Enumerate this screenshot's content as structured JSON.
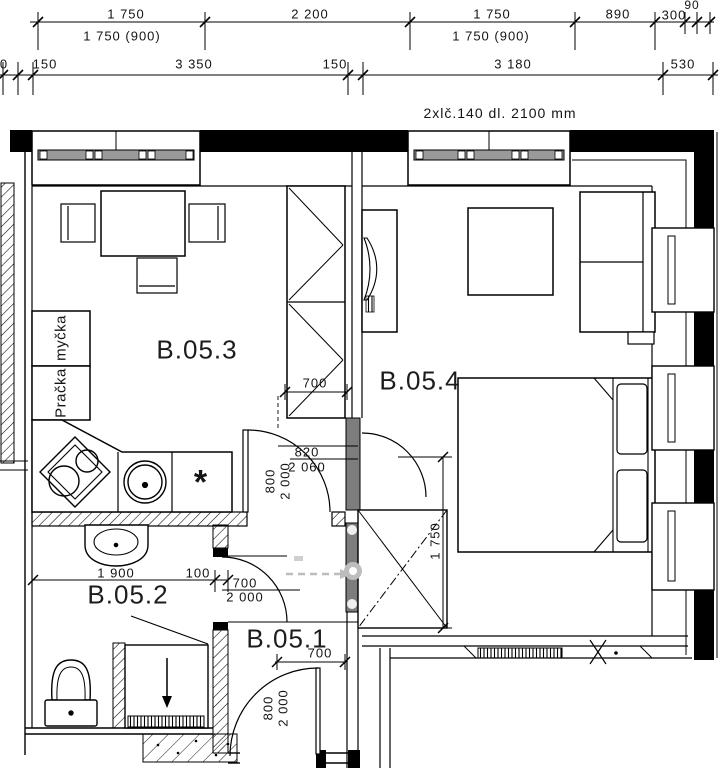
{
  "drawing": {
    "note": "2xlč.140 dl. 2100 mm",
    "rooms": {
      "kitchen_living": "B.05.3",
      "bedroom": "B.05.4",
      "bathroom": "B.05.2",
      "hall": "B.05.1"
    },
    "appliances": {
      "washing_machine": "Pračka",
      "dishwasher": "myčka",
      "star_mark": "*"
    },
    "dim_rows": {
      "row1": [
        "1 750",
        "2 200",
        "1 750",
        "890",
        "300"
      ],
      "row1_small": "90",
      "row1_sub": [
        "1 750 (900)",
        "1 750 (900)"
      ],
      "row2": [
        "0",
        "150",
        "3 350",
        "150",
        "3 180",
        "530"
      ]
    },
    "dims": {
      "wardrobe_width": "700",
      "kitchen_door_w": "820",
      "kitchen_door_h": "2 060",
      "kitchen_door_cw": "800",
      "kitchen_door_ch": "2 000",
      "bed_zone": "1 750",
      "bath_width": "1 900",
      "bath_gap": "100",
      "bath_door_w": "700",
      "bath_door_h": "2 000",
      "entry_w": "700",
      "entry_cw": "800",
      "entry_ch": "2 000"
    },
    "colors": {
      "line": "#000000",
      "gray_wall": "#7d7d7d",
      "window_bar": "#9a9a9a",
      "watermark": "#bdbdbd"
    }
  }
}
